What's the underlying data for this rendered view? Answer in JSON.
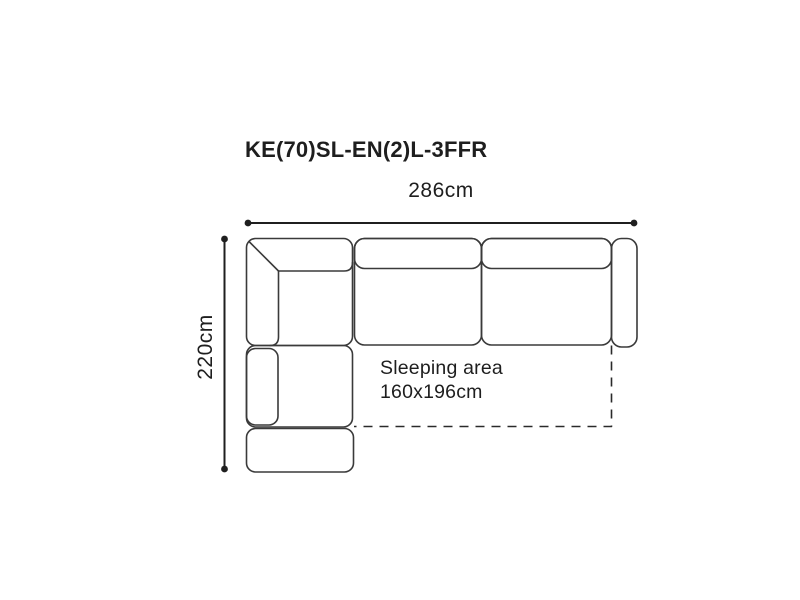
{
  "diagram": {
    "title": "KE(70)SL-EN(2)L-3FFR",
    "dimensions": {
      "width_label": "286cm",
      "height_label": "220cm"
    },
    "sleeping_area": {
      "label_line1": "Sleeping area",
      "label_line2": "160x196cm"
    },
    "colors": {
      "background": "#ffffff",
      "sofa_outline": "#3a3a3a",
      "dimension_line": "#1f1f1f",
      "sleeping_boundary": "#2a2a2a",
      "text": "#1e1e1e"
    }
  }
}
